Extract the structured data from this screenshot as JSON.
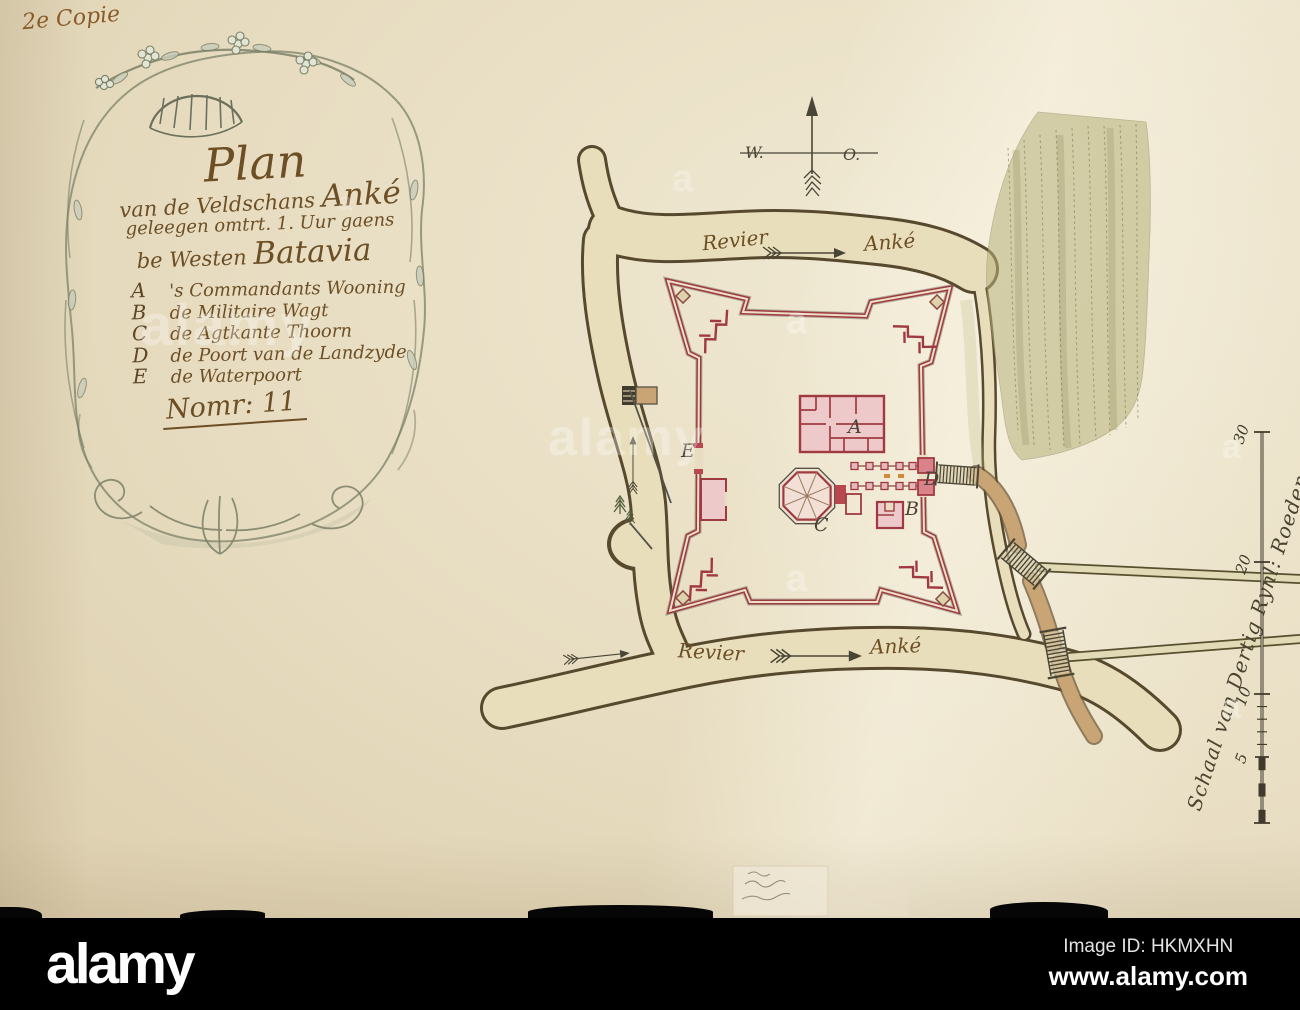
{
  "page": {
    "annotation": "2e Copie"
  },
  "cartouche": {
    "title": {
      "word1": "Plan",
      "line2_prefix": "van de Veldschans ",
      "line2_name": "Anké",
      "line3": "geleegen omtrt. 1. Uur gaens",
      "line4_prefix": "be Westen ",
      "line4_name": "Batavia"
    },
    "legend": [
      {
        "key": "A",
        "label": "'s Commandants Wooning"
      },
      {
        "key": "B",
        "label": "de Militaire Wagt"
      },
      {
        "key": "C",
        "label": "de Agtkante Thoorn"
      },
      {
        "key": "D",
        "label": "de Poort van de Landzyde"
      },
      {
        "key": "E",
        "label": "de Waterpoort"
      }
    ],
    "number": "Nomr: 11"
  },
  "compass": {
    "west": "W.",
    "east": "O."
  },
  "map_labels": {
    "river_top": "Revier",
    "river_top_name": "Anké",
    "river_bottom": "Revier",
    "river_bottom_name": "Anké",
    "building_a": "A",
    "building_b": "B",
    "tower_c": "C",
    "gate_d": "D",
    "watergate_e": "E"
  },
  "scale": {
    "caption": "Schaal van Dertig Rynl: Roeden",
    "ticks": [
      "30",
      "20",
      "10",
      "5"
    ]
  },
  "watermark": {
    "logo": "alamy",
    "image_id": "Image ID: HKMXHN",
    "url": "www.alamy.com",
    "ghost_word": "alamy",
    "ghost_letter": "a"
  },
  "colors": {
    "paper": "#e8ddc2",
    "ink_brown": "#6d4f26",
    "fort_red": "#a03a42",
    "water": "#e9debb",
    "bank": "#57492e",
    "plantation": "#b8b37c",
    "path_brown": "#c9a474",
    "bar": "#000000"
  }
}
